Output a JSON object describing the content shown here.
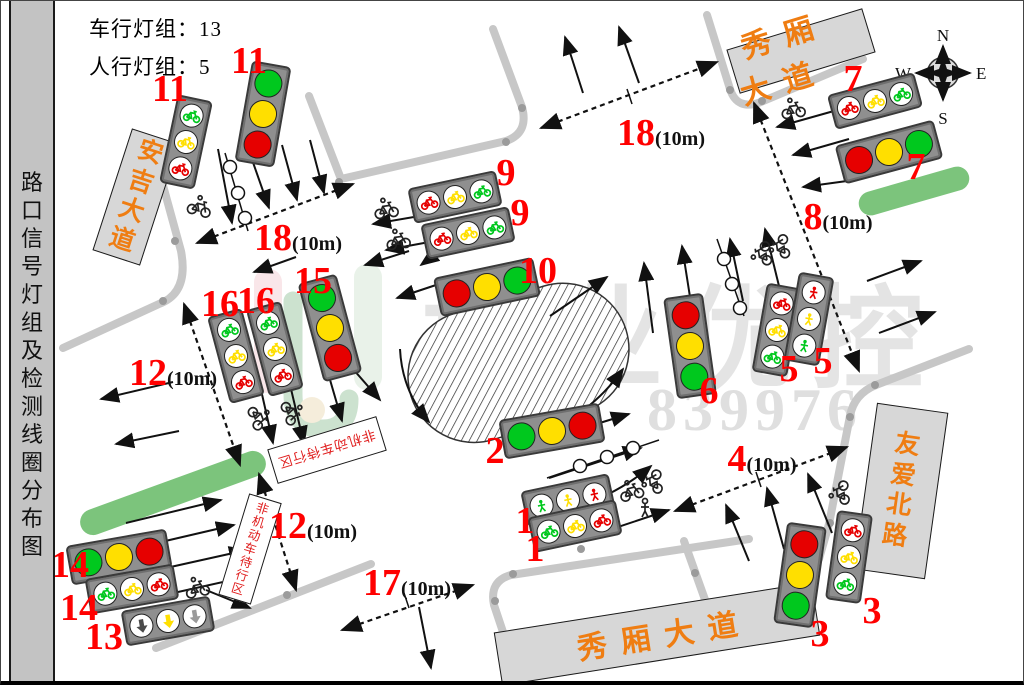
{
  "sidebar": {
    "title": "路口信号灯组及检测线圈分布图"
  },
  "header": {
    "vehicle_groups": "车行灯组：13",
    "ped_groups": "人行灯组：5"
  },
  "compass": {
    "north": "N",
    "south": "S",
    "east": "E",
    "west": "W"
  },
  "watermark": {
    "brand": "振业优控",
    "code": "密码：839976"
  },
  "palette": {
    "red": "#e60000",
    "yellow": "#ffdf00",
    "green": "#00c81e",
    "darkgray": "#4a4a4a",
    "lightgray": "#9a9a9a",
    "label_red": "#ff0000",
    "sign_orange": "#ef7d12",
    "median_green": "#7cc47c",
    "road_gray": "#c7c7c7"
  },
  "road_signs": [
    {
      "name": "anji-avenue",
      "text": "安吉大道",
      "cx": 135,
      "cy": 196,
      "w": 50,
      "h": 128,
      "rot": 18,
      "vertical": true
    },
    {
      "name": "xiuxiang-avenue-north",
      "text": "秀厢大道",
      "cx": 800,
      "cy": 50,
      "w": 142,
      "h": 46,
      "rot": -17,
      "vertical": false
    },
    {
      "name": "xiuxiang-avenue-south",
      "text": "秀厢大道",
      "cx": 656,
      "cy": 633,
      "w": 322,
      "h": 54,
      "rot": -9,
      "vertical": false
    },
    {
      "name": "youai-north-road",
      "text": "友爱北路",
      "cx": 900,
      "cy": 490,
      "w": 72,
      "h": 168,
      "rot": 8,
      "vertical": true
    }
  ],
  "wait_zone_signs": [
    {
      "text": "非机动车待行区",
      "cx": 326,
      "cy": 449,
      "w": 114,
      "h": 36,
      "rot": 163,
      "vertical": false
    },
    {
      "text": "非机动车待行区",
      "cx": 249,
      "cy": 548,
      "w": 34,
      "h": 106,
      "rot": 17,
      "vertical": true
    }
  ],
  "labels": [
    {
      "num": "11",
      "x": 169,
      "y": 88
    },
    {
      "num": "11",
      "x": 248,
      "y": 60
    },
    {
      "num": "9",
      "x": 505,
      "y": 172
    },
    {
      "num": "9",
      "x": 519,
      "y": 212
    },
    {
      "num": "10",
      "x": 537,
      "y": 270
    },
    {
      "num": "18",
      "suffix": "(10m)",
      "x": 297,
      "y": 237
    },
    {
      "num": "18",
      "suffix": "(10m)",
      "x": 660,
      "y": 132
    },
    {
      "num": "7",
      "x": 852,
      "y": 78
    },
    {
      "num": "7",
      "x": 915,
      "y": 166
    },
    {
      "num": "8",
      "suffix": "(10m)",
      "x": 837,
      "y": 216
    },
    {
      "num": "16",
      "x": 219,
      "y": 303
    },
    {
      "num": "16",
      "x": 255,
      "y": 300
    },
    {
      "num": "15",
      "x": 312,
      "y": 280
    },
    {
      "num": "12",
      "suffix": "(10m)",
      "x": 172,
      "y": 372
    },
    {
      "num": "12",
      "suffix": "(10m)",
      "x": 312,
      "y": 525
    },
    {
      "num": "5",
      "x": 788,
      "y": 368
    },
    {
      "num": "5",
      "x": 822,
      "y": 360
    },
    {
      "num": "6",
      "x": 708,
      "y": 390
    },
    {
      "num": "4",
      "suffix": "(10m)",
      "x": 761,
      "y": 458
    },
    {
      "num": "2",
      "x": 494,
      "y": 450
    },
    {
      "num": "1",
      "x": 524,
      "y": 520
    },
    {
      "num": "1",
      "x": 534,
      "y": 548
    },
    {
      "num": "17",
      "suffix": "(10m)",
      "x": 406,
      "y": 582
    },
    {
      "num": "14",
      "x": 69,
      "y": 564
    },
    {
      "num": "14",
      "x": 78,
      "y": 607
    },
    {
      "num": "13",
      "x": 103,
      "y": 636
    },
    {
      "num": "3",
      "x": 819,
      "y": 633
    },
    {
      "num": "3",
      "x": 871,
      "y": 610
    }
  ],
  "traffic_lights": [
    {
      "group": "11-bike",
      "cx": 185,
      "cy": 141,
      "rot": 12,
      "o": "v",
      "type": "bike",
      "colors": [
        "green",
        "yellow",
        "red"
      ]
    },
    {
      "group": "11-vehicle",
      "cx": 262,
      "cy": 113,
      "rot": 10,
      "o": "v",
      "type": "vehicle",
      "colors": [
        "green",
        "yellow",
        "red"
      ]
    },
    {
      "group": "9-bike-a",
      "cx": 454,
      "cy": 196,
      "rot": -12,
      "o": "h",
      "type": "bike",
      "colors": [
        "red",
        "yellow",
        "green"
      ]
    },
    {
      "group": "9-bike-b",
      "cx": 467,
      "cy": 232,
      "rot": -12,
      "o": "h",
      "type": "bike",
      "colors": [
        "red",
        "yellow",
        "green"
      ]
    },
    {
      "group": "10-vehicle",
      "cx": 486,
      "cy": 286,
      "rot": -12,
      "o": "h",
      "type": "vehicle",
      "colors": [
        "red",
        "yellow",
        "green"
      ]
    },
    {
      "group": "15-vehicle",
      "cx": 329,
      "cy": 327,
      "rot": -15,
      "o": "v",
      "type": "vehicle",
      "colors": [
        "green",
        "yellow",
        "red"
      ]
    },
    {
      "group": "16-bike-a",
      "cx": 274,
      "cy": 348,
      "rot": -15,
      "o": "v",
      "type": "bike",
      "colors": [
        "green",
        "yellow",
        "red"
      ]
    },
    {
      "group": "16-bike-b",
      "cx": 235,
      "cy": 355,
      "rot": -15,
      "o": "v",
      "type": "bike",
      "colors": [
        "green",
        "yellow",
        "red"
      ]
    },
    {
      "group": "6-vehicle",
      "cx": 689,
      "cy": 345,
      "rot": -8,
      "o": "v",
      "type": "vehicle",
      "colors": [
        "red",
        "yellow",
        "green"
      ]
    },
    {
      "group": "5-bike",
      "cx": 776,
      "cy": 329,
      "rot": 10,
      "o": "v",
      "type": "bike",
      "colors": [
        "red",
        "yellow",
        "green"
      ]
    },
    {
      "group": "5-ped",
      "cx": 808,
      "cy": 318,
      "rot": 10,
      "o": "v",
      "type": "ped",
      "colors": [
        "red",
        "yellow",
        "green"
      ]
    },
    {
      "group": "7-bike",
      "cx": 874,
      "cy": 100,
      "rot": -15,
      "o": "h",
      "type": "bike",
      "colors": [
        "red",
        "yellow",
        "green"
      ]
    },
    {
      "group": "7-vehicle",
      "cx": 888,
      "cy": 151,
      "rot": -15,
      "o": "h",
      "type": "vehicle",
      "colors": [
        "red",
        "yellow",
        "green"
      ]
    },
    {
      "group": "2-vehicle",
      "cx": 551,
      "cy": 430,
      "rot": -10,
      "o": "h",
      "type": "vehicle",
      "colors": [
        "green",
        "yellow",
        "red"
      ]
    },
    {
      "group": "1-ped",
      "cx": 567,
      "cy": 499,
      "rot": -12,
      "o": "h",
      "type": "ped",
      "colors": [
        "green",
        "yellow",
        "red"
      ]
    },
    {
      "group": "1-bike",
      "cx": 574,
      "cy": 525,
      "rot": -12,
      "o": "h",
      "type": "bike",
      "colors": [
        "green",
        "yellow",
        "red"
      ]
    },
    {
      "group": "3-vehicle",
      "cx": 799,
      "cy": 574,
      "rot": 8,
      "o": "v",
      "type": "vehicle",
      "colors": [
        "red",
        "yellow",
        "green"
      ]
    },
    {
      "group": "3-bike",
      "cx": 848,
      "cy": 556,
      "rot": 8,
      "o": "v",
      "type": "bike",
      "colors": [
        "red",
        "yellow",
        "green"
      ]
    },
    {
      "group": "14-vehicle",
      "cx": 118,
      "cy": 556,
      "rot": -10,
      "o": "h",
      "type": "vehicle",
      "colors": [
        "green",
        "yellow",
        "red"
      ]
    },
    {
      "group": "14-bike",
      "cx": 131,
      "cy": 588,
      "rot": -10,
      "o": "h",
      "type": "bike",
      "colors": [
        "green",
        "yellow",
        "red"
      ]
    },
    {
      "group": "13-arrow",
      "cx": 167,
      "cy": 620,
      "rot": -10,
      "o": "h",
      "type": "arrow",
      "colors": [
        "darkgray",
        "yellow",
        "lightgray"
      ]
    }
  ]
}
